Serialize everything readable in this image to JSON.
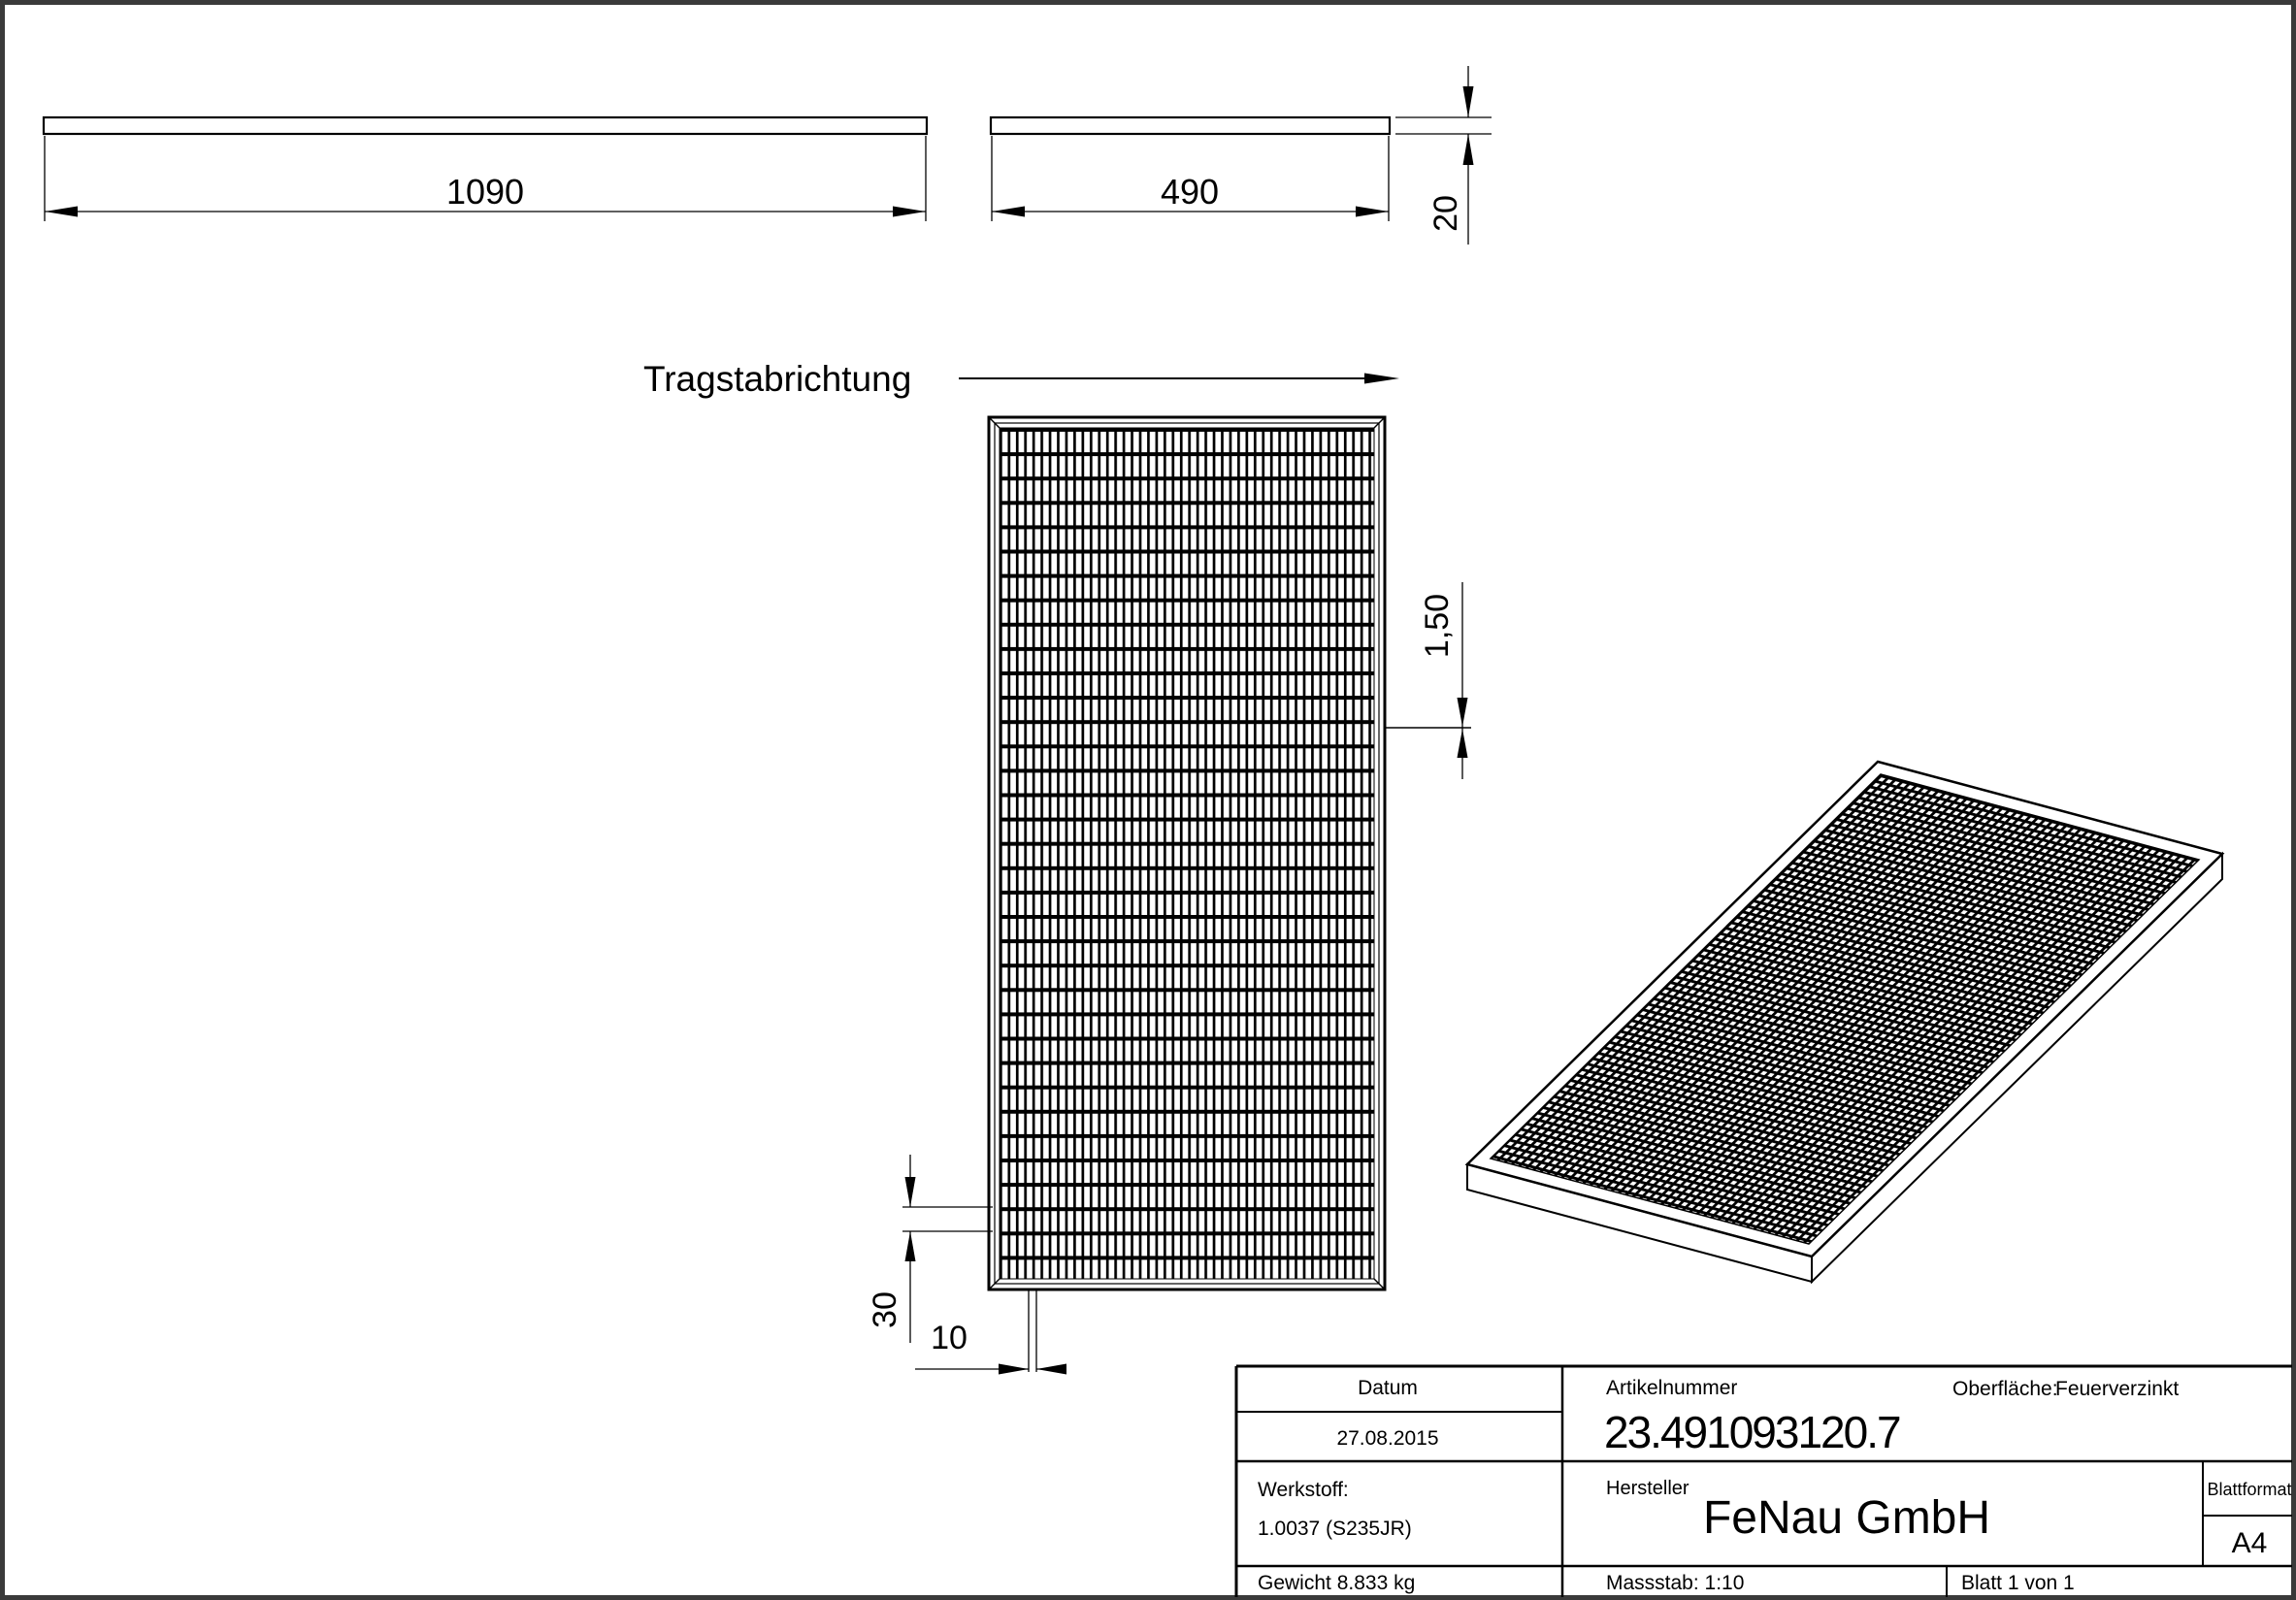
{
  "drawing": {
    "direction_label": "Tragstabrichtung",
    "dim_length": "1090",
    "dim_width": "490",
    "dim_thickness": "20",
    "dim_crossbar": "1,50",
    "dim_pitch_long": "30",
    "dim_pitch_cross": "10"
  },
  "title_block": {
    "datum_label": "Datum",
    "datum_value": "27.08.2015",
    "artikelnummer_label": "Artikelnummer",
    "artikelnummer_value": "23.491093120.7",
    "oberflaeche_label": "Oberfläche:",
    "oberflaeche_value": "Feuerverzinkt",
    "werkstoff_label": "Werkstoff:",
    "werkstoff_value": "1.0037 (S235JR)",
    "hersteller_label": "Hersteller",
    "hersteller_value": "FeNau GmbH",
    "blattformat_label": "Blattformat",
    "blattformat_value": "A4",
    "gewicht_text": "Gewicht 8.833 kg",
    "massstab_text": "Massstab: 1:10",
    "blatt_text": "Blatt 1 von 1"
  },
  "colors": {
    "line": "#000000",
    "page_border": "#3a3a3a",
    "background": "#ffffff"
  }
}
